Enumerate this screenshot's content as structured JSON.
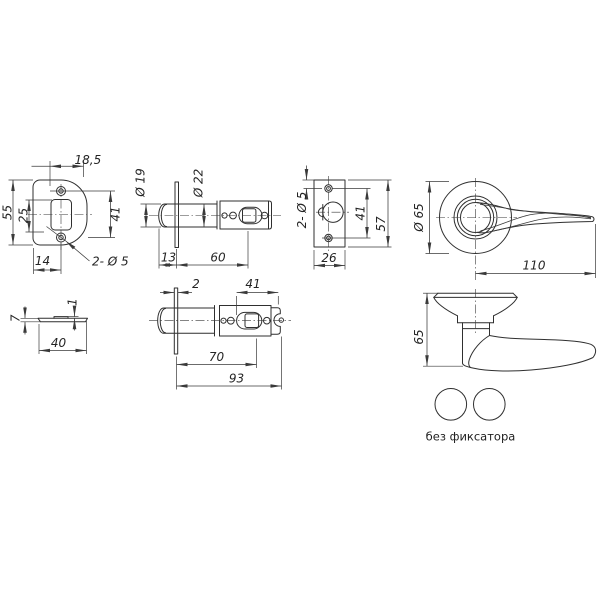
{
  "caption": "без фиксатора",
  "views": {
    "strike_front": {
      "width_top": "18,5",
      "height": "55",
      "cutout_height": "25",
      "hole_spacing": "41",
      "hole_offset": "14",
      "holes_note": "2- Ø 5"
    },
    "latch_top": {
      "bolt_dia": "Ø 19",
      "body_dia": "Ø 22",
      "head_length": "13",
      "backset": "60"
    },
    "strike_narrow": {
      "holes_note": "2- Ø 5",
      "hole_spacing": "41",
      "height": "57",
      "width": "26"
    },
    "handle_top": {
      "rose_dia": "Ø 65",
      "lever_length": "110"
    },
    "plate_side": {
      "thickness": "7",
      "tab_height": "1",
      "length": "40"
    },
    "latch_side": {
      "faceplate_thickness": "2",
      "tail_length": "41",
      "spindle_distance": "70",
      "total_length": "93"
    },
    "handle_side": {
      "height": "65"
    }
  }
}
